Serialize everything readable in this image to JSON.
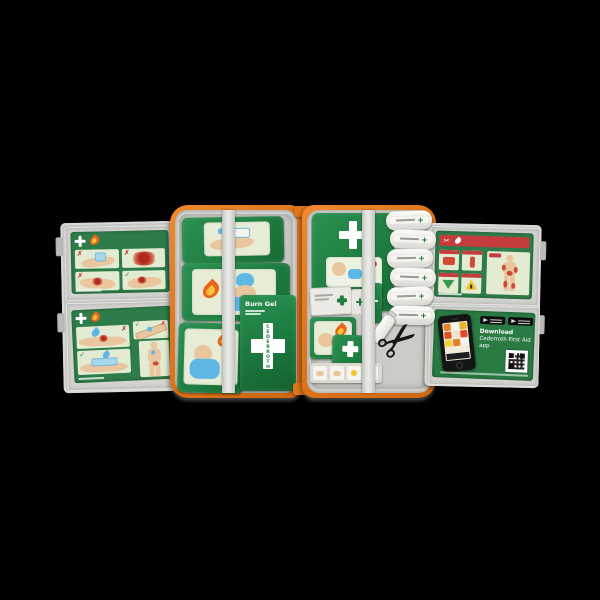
{
  "kit": {
    "background_color": "#000000",
    "colors": {
      "case_orange": "#e2761b",
      "lining_gray": "#d6d6d2",
      "flap_panel_gray": "#c6c6c2",
      "package_green": "#1f7e41",
      "card_green": "#2e7c49",
      "illustration_bg": "#e3ebd3",
      "header_red": "#c53c3c",
      "skin_tone": "#e9c69e",
      "wound_red": "#c94b35",
      "water_blue": "#5fb7e6",
      "roll_white": "#f2f1ec",
      "scissors_black": "#161616"
    },
    "marks": {
      "x": "✗",
      "check": "✓"
    },
    "glyphs": {
      "scissors": "✂"
    },
    "icons": {
      "white_cross": "plus-shape",
      "flame": "teardrop-shape",
      "water_drop": "teardrop-shape",
      "google_play_badge": "black-badge",
      "app_store_badge": "black-badge",
      "qr_code": "qr-pattern"
    },
    "burn_gel_pack": {
      "label": "Burn Gel",
      "brand": "CEDERROTH"
    },
    "app_card": {
      "title_line1": "Download",
      "title_line2": "Cederroth First Aid app"
    },
    "bandage_rolls_count": 6
  }
}
